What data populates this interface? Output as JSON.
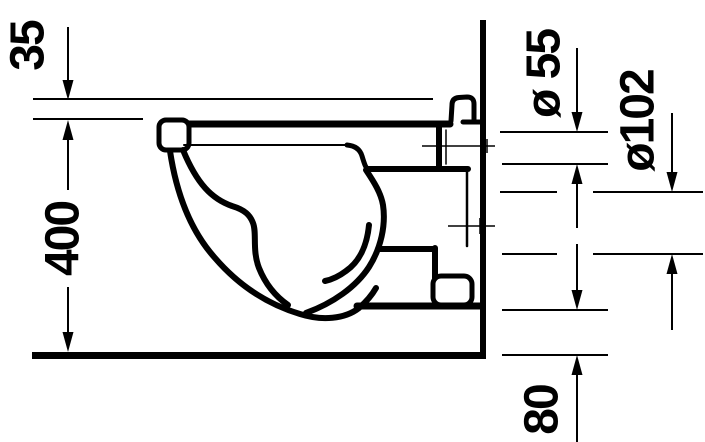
{
  "drawing": {
    "title": "Wall-hung toilet side elevation technical drawing",
    "dimensions": {
      "d35": {
        "label": "35"
      },
      "d400": {
        "label": "400"
      },
      "d55": {
        "label": "ø 55"
      },
      "d102": {
        "label": "ø102"
      },
      "d80": {
        "label": "80"
      }
    },
    "colors": {
      "ink": "#000000",
      "background": "#ffffff"
    }
  }
}
